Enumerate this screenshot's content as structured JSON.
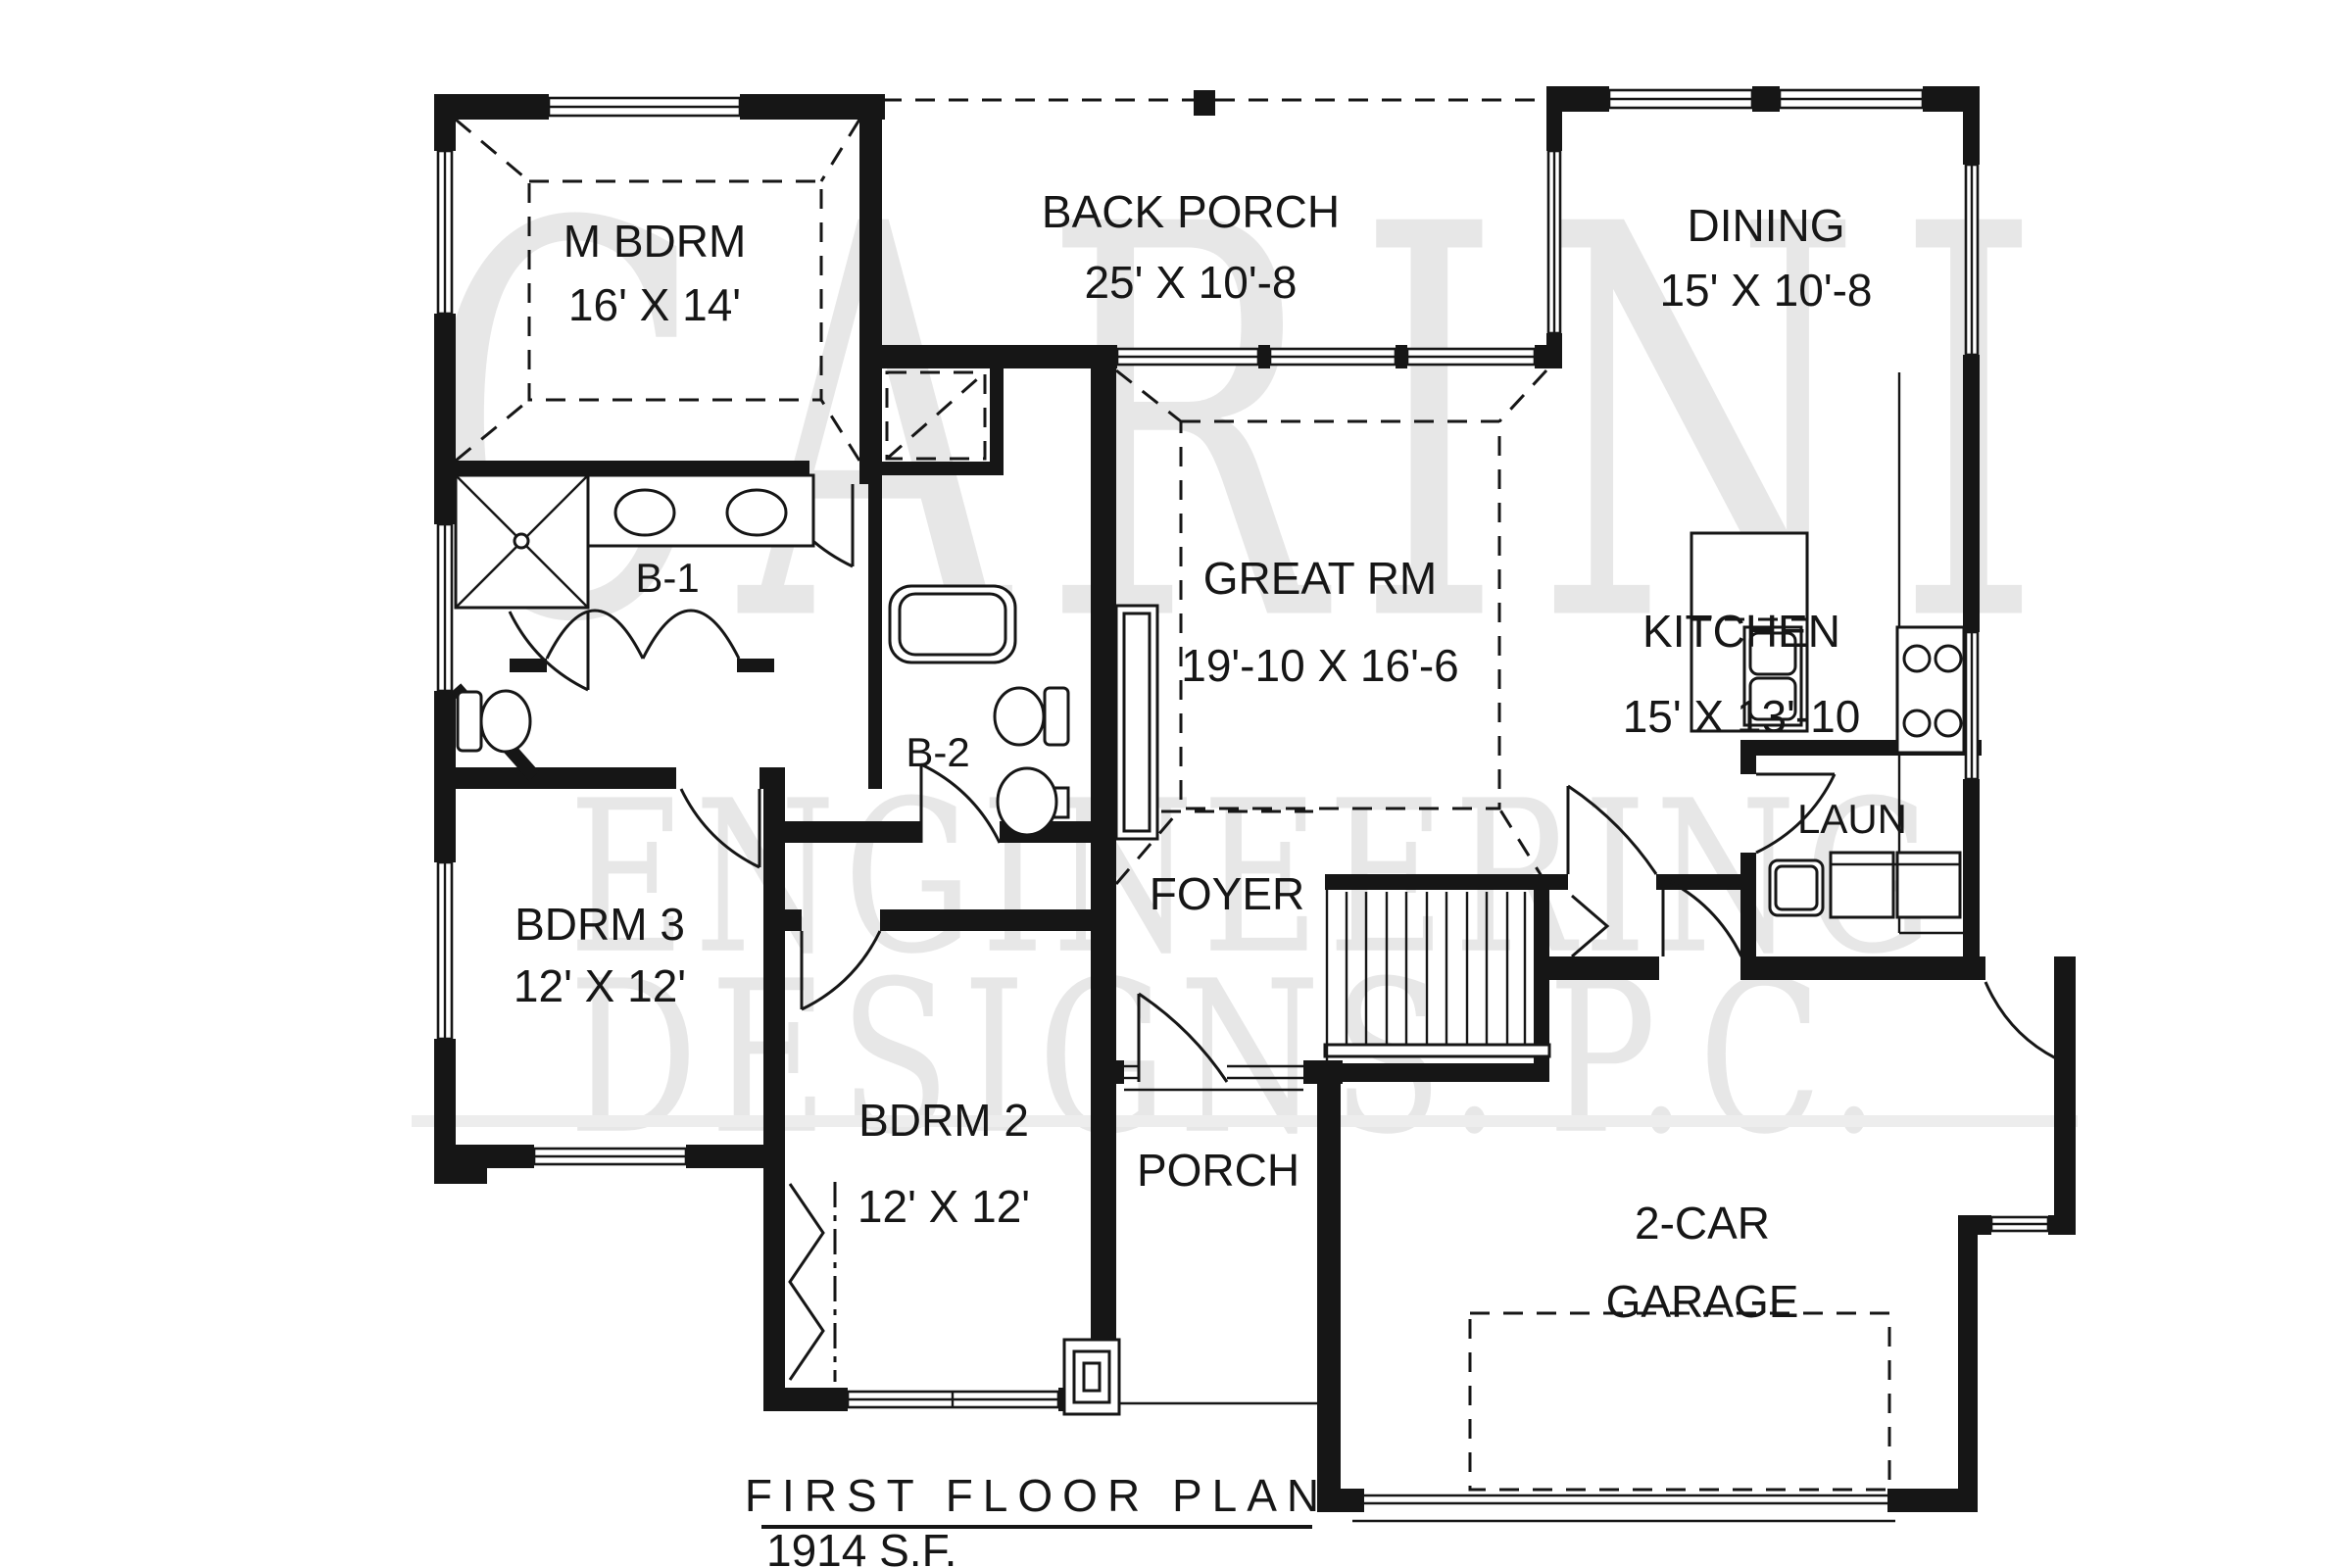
{
  "document": {
    "kind": "first-floor-plan-drawing"
  },
  "rooms": {
    "m_bdrm": {
      "name": "M BDRM",
      "dims": "16' X 14'"
    },
    "back_porch": {
      "name": "BACK PORCH",
      "dims": "25' X 10'-8"
    },
    "dining": {
      "name": "DINING",
      "dims": "15' X 10'-8"
    },
    "great_rm": {
      "name": "GREAT RM",
      "dims": "19'-10 X 16'-6"
    },
    "kitchen": {
      "name": "KITCHEN",
      "dims": "15' X 13'-10"
    },
    "bath1": {
      "name": "B-1"
    },
    "bath2": {
      "name": "B-2"
    },
    "laundry": {
      "name": "LAUN"
    },
    "foyer": {
      "name": "FOYER"
    },
    "bdrm3": {
      "name": "BDRM 3",
      "dims": "12' X 12'"
    },
    "bdrm2": {
      "name": "BDRM 2",
      "dims": "12' X 12'"
    },
    "porch": {
      "name": "PORCH"
    },
    "garage": {
      "line1": "2-CAR",
      "line2": "GARAGE"
    }
  },
  "title_block": {
    "title": "FIRST FLOOR PLAN",
    "area": "1914 S.F."
  },
  "watermark": {
    "line1": "CARINI",
    "line2": "ENGINEERING",
    "line3_left": "DESIGNS.",
    "line3_right": "P.C."
  },
  "colors": {
    "ink": "#161616",
    "watermark": "#e7e7e7",
    "background": "#ffffff"
  }
}
